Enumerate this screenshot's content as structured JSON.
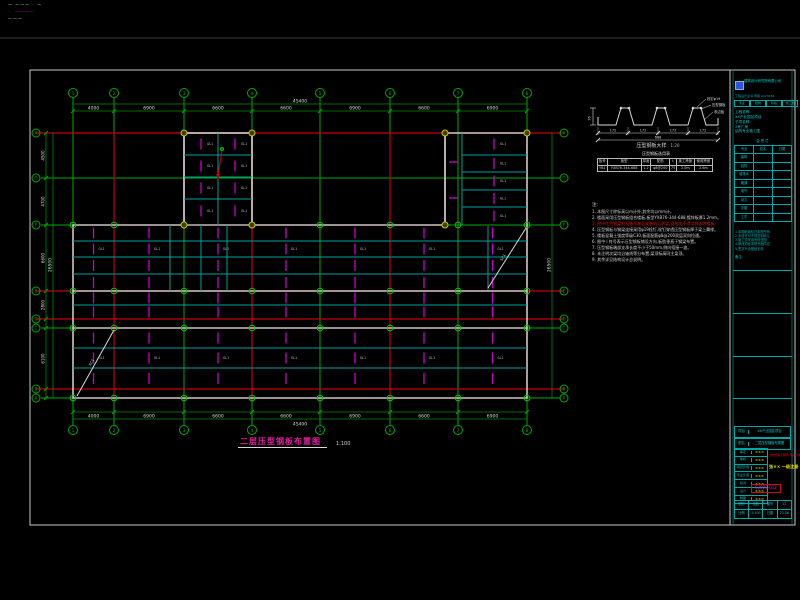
{
  "colors": {
    "green": "#00aa00",
    "dimgreen": "#008c00",
    "red": "#c80000",
    "cyan": "#00a0a0",
    "magenta": "#cc00cc",
    "white": "#d8d8d8",
    "gray": "#d2c4c4",
    "yellow": "#c8c800",
    "node_green": "#00c800",
    "faint": "#3a3a3a",
    "border": "#c8c8c8"
  },
  "corner_texts": [
    {
      "text": "— ——— · —",
      "color": "#d8d8d8"
    },
    {
      "text": "·· ————",
      "color": "#cc00cc"
    },
    {
      "text": "———",
      "color": "#d8d8d8"
    }
  ],
  "plan": {
    "title": "二层压型钢板布置图",
    "scale": "1:100",
    "cols": {
      "labels": [
        "1",
        "2",
        "3",
        "4",
        "5",
        "6",
        "7",
        "8"
      ],
      "x": [
        73,
        114,
        184,
        252,
        320,
        390,
        458,
        527
      ]
    },
    "rows": {
      "labels": [
        "H",
        "G",
        "F",
        "E",
        "D",
        "C",
        "B",
        "A"
      ],
      "y": [
        133,
        178,
        225,
        291,
        319,
        328,
        389,
        398
      ]
    },
    "red_rows": [
      133,
      291,
      319,
      389
    ],
    "red_cols": [
      114,
      252,
      390,
      527
    ],
    "top_dims": [
      "4000",
      "6900",
      "6600",
      "6600",
      "6900",
      "6600",
      "6900"
    ],
    "left_dims": [
      "4500",
      "4700",
      "6600",
      "2800",
      "900",
      "6100",
      "900"
    ],
    "overall_top": "45400",
    "overall_left": "26500",
    "outline": [
      [
        73,
        225
      ],
      [
        184,
        225
      ],
      [
        184,
        133
      ],
      [
        252,
        133
      ],
      [
        252,
        225
      ],
      [
        445,
        225
      ],
      [
        445,
        133
      ],
      [
        527,
        133
      ],
      [
        527,
        398
      ],
      [
        73,
        398
      ]
    ],
    "gray_inner_rows": [
      291,
      328
    ],
    "bands": [
      {
        "y_lines": [
          225,
          241,
          257,
          274,
          291
        ]
      },
      {
        "y_lines": [
          291,
          305,
          319
        ]
      },
      {
        "y_lines": [
          328,
          348,
          368,
          389
        ]
      }
    ],
    "room": {
      "x0": 184,
      "x1": 252,
      "y0": 133,
      "y1": 225,
      "mid_x": 218,
      "h_lines": [
        155,
        177,
        199
      ]
    },
    "right_block": {
      "x0": 445,
      "x1": 527,
      "y0": 133,
      "y1": 225,
      "v_line": 462,
      "h_lines": [
        155,
        172,
        190,
        207
      ]
    },
    "extra_v_cyan": [
      [
        170,
        225,
        291
      ],
      [
        201,
        225,
        291
      ],
      [
        227,
        225,
        291
      ],
      [
        488,
        226,
        290
      ]
    ],
    "braces": [
      {
        "x1": 77,
        "y1": 396,
        "x2": 114,
        "y2": 330,
        "label": "SC1"
      },
      {
        "x1": 488,
        "y1": 288,
        "x2": 526,
        "y2": 228,
        "label": "SC1"
      }
    ],
    "cell_label": "GL1"
  },
  "detail": {
    "caption": "压型钢板大样",
    "scale": "1:20",
    "seg_dims": [
      "172",
      "172",
      "172",
      "172"
    ],
    "total_dim": "688",
    "height_dim": "76",
    "callouts": [
      "栓钉φ19",
      "压型钢板",
      "收边板"
    ]
  },
  "deck_table": {
    "title": "压型钢板选用表",
    "headers": [
      "板号",
      "板型",
      "厚度",
      "配筋",
      "t",
      "施工跨度",
      "使用跨度"
    ],
    "row": [
      "YB1",
      "YXB76-344-688",
      "1.2",
      "φ8@200",
      "75",
      "2.0m",
      "2.6m"
    ]
  },
  "notes": {
    "title": "注:",
    "red_index": 2,
    "items": [
      "1. 本图尺寸除标高以m计外,其余均以mm计。",
      "2. 楼面采用压型钢板组合楼板,板型YXB76-344-688,镀锌板厚1.2mm。",
      "3. 图中红色钢梁为设备吊装后安装的后装梁,安装前不得浇筑该跨楼板。",
      "4. 压型钢板与钢梁连接采用φ19栓钉,栓钉穿透压型钢板焊于梁上翼缘。",
      "5. 楼板混凝土强度等级C30,板面配筋φ8@200双层双向拉通。",
      "6. 图中 I 符号表示压型钢板铺设方向,板肋垂直于钢梁布置。",
      "7. 压型钢板端部支承长度不小于50mm,侧向搭接一波。",
      "8. 未注明次梁均沿轴线等分布置,梁顶标高同主梁顶。",
      "9. 其余详见结构设计总说明。"
    ]
  },
  "titleblock": {
    "company": "建筑设计研究院有限公司",
    "cert_line": "工程设计证书 甲级 A123456",
    "header_cells": [
      "专业",
      "结构",
      "阶段",
      "施工图"
    ],
    "info_lines": [
      "工程名称:",
      "XX产业园区项目",
      "子项名称:",
      "2号厂房",
      "结构专业施工图"
    ],
    "sign_title": "会 签 栏",
    "sign_rows": [
      [
        "专业",
        "姓名",
        "日期"
      ],
      [
        "建筑",
        "",
        ""
      ],
      [
        "结构",
        "",
        ""
      ],
      [
        "给排水",
        "",
        ""
      ],
      [
        "暖通",
        "",
        ""
      ],
      [
        "电气",
        "",
        ""
      ],
      [
        "动力",
        "",
        ""
      ],
      [
        "总图",
        "",
        ""
      ],
      [
        "工艺",
        "",
        ""
      ]
    ],
    "clauses": [
      "1.本图纸版权归本院所有",
      "2.未经许可不得复制转让",
      "3.施工须采用有效蓝图",
      "4.修改须经本院书面同意",
      "5.签字不全图纸无效"
    ],
    "remark_label": "备注:",
    "project_rows": [
      [
        "项目",
        "XX产业园区项目"
      ],
      [
        "图名",
        "二层压型钢板布置图"
      ]
    ],
    "sig_rows": [
      [
        "审定",
        "×××"
      ],
      [
        "审核",
        "×××"
      ],
      [
        "项目负责",
        "×××"
      ],
      [
        "专业负责",
        "×××"
      ],
      [
        "校对",
        "×××"
      ],
      [
        "设计",
        "×××"
      ],
      [
        "制图",
        "×××"
      ]
    ],
    "red_stamp": "注册结构工程师 执业印章",
    "yellow_stamp": "张×× 一级注册",
    "doc_no": "S2023-012",
    "bottom_rows": [
      [
        "图别",
        "结施",
        "图号",
        "12"
      ],
      [
        "比例",
        "1:100",
        "日期",
        "23.06"
      ]
    ]
  }
}
